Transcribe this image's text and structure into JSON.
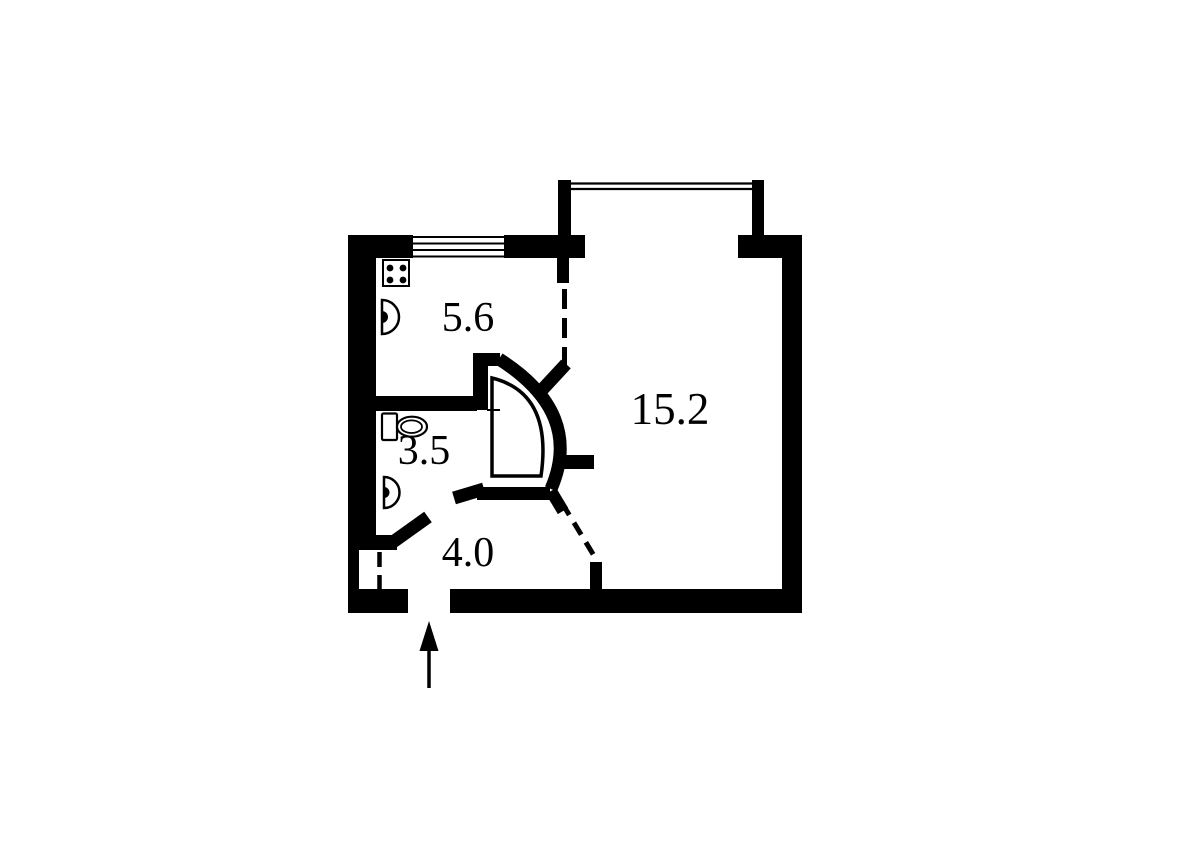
{
  "page": {
    "background_color": "#ffffff",
    "wall_color": "#000000",
    "drawing_type": "apartment-floor-plan"
  },
  "floor_plan": {
    "rooms": [
      {
        "name": "kitchen",
        "area_label": "5.6",
        "fixtures": [
          "stove-icon",
          "sink-icon"
        ],
        "window": true
      },
      {
        "name": "bathroom",
        "area_label": "3.5",
        "fixtures": [
          "toilet-icon",
          "sink-icon",
          "shower-cabin-icon"
        ],
        "window": false
      },
      {
        "name": "hallway",
        "area_label": "4.0",
        "fixtures": [
          "entrance-arrow-icon",
          "closet-door-dashed-line"
        ],
        "window": false
      },
      {
        "name": "living-room",
        "area_label": "15.2",
        "fixtures": [],
        "window": true
      }
    ],
    "symbols": [
      "kitchen-window-icon",
      "living-room-window-icon",
      "kitchen-opening-dashed-line",
      "living-room-opening-dashed-line",
      "closet-door-dashed-line",
      "entrance-arrow-icon"
    ]
  }
}
